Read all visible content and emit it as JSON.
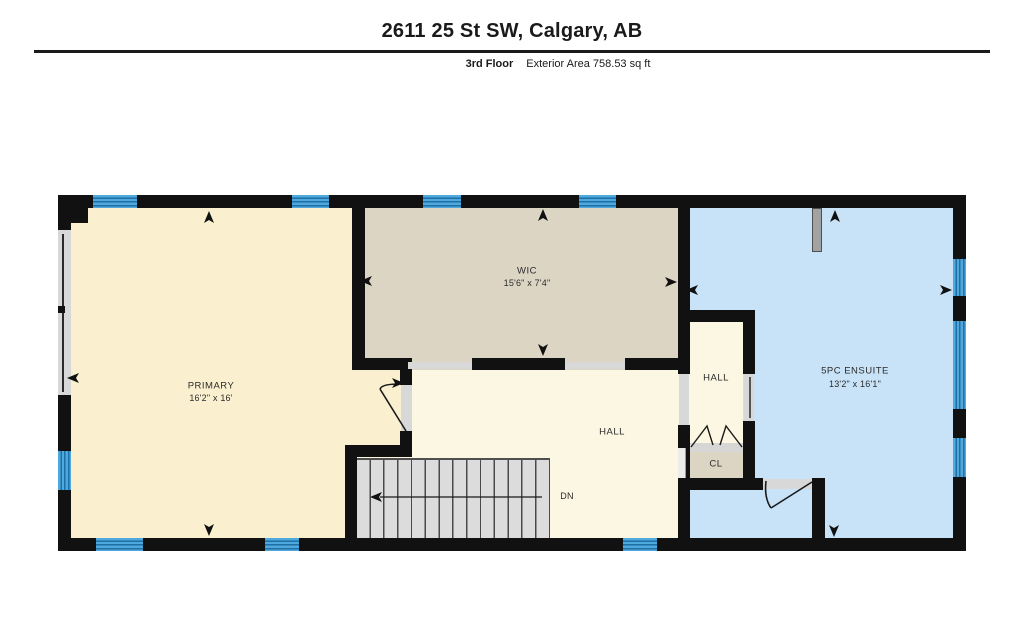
{
  "header": {
    "title": "2611 25 St SW, Calgary, AB",
    "floor_label": "3rd Floor",
    "area_label": "Exterior Area 758.53 sq ft"
  },
  "rooms": {
    "primary": {
      "label": "PRIMARY",
      "dims": "16'2\" x 16'"
    },
    "wic": {
      "label": "WIC",
      "dims": "15'6\" x 7'4\""
    },
    "hall_main": {
      "label": "HALL"
    },
    "hall_small": {
      "label": "HALL"
    },
    "closet": {
      "label": "CL"
    },
    "ensuite": {
      "label": "5PC ENSUITE",
      "dims": "13'2\" x 16'1\""
    }
  },
  "stairs": {
    "direction_label": "DN"
  },
  "colors": {
    "wall": "#111111",
    "window_blue": "#4fa9dc",
    "window_stripe": "#1e6fa6",
    "primary_fill": "#faf0d0",
    "hall_fill": "#fcf7e3",
    "wic_fill": "#dcd5c4",
    "ensuite_fill": "#c8e3f7",
    "stairs_fill": "#dcdcdc"
  }
}
